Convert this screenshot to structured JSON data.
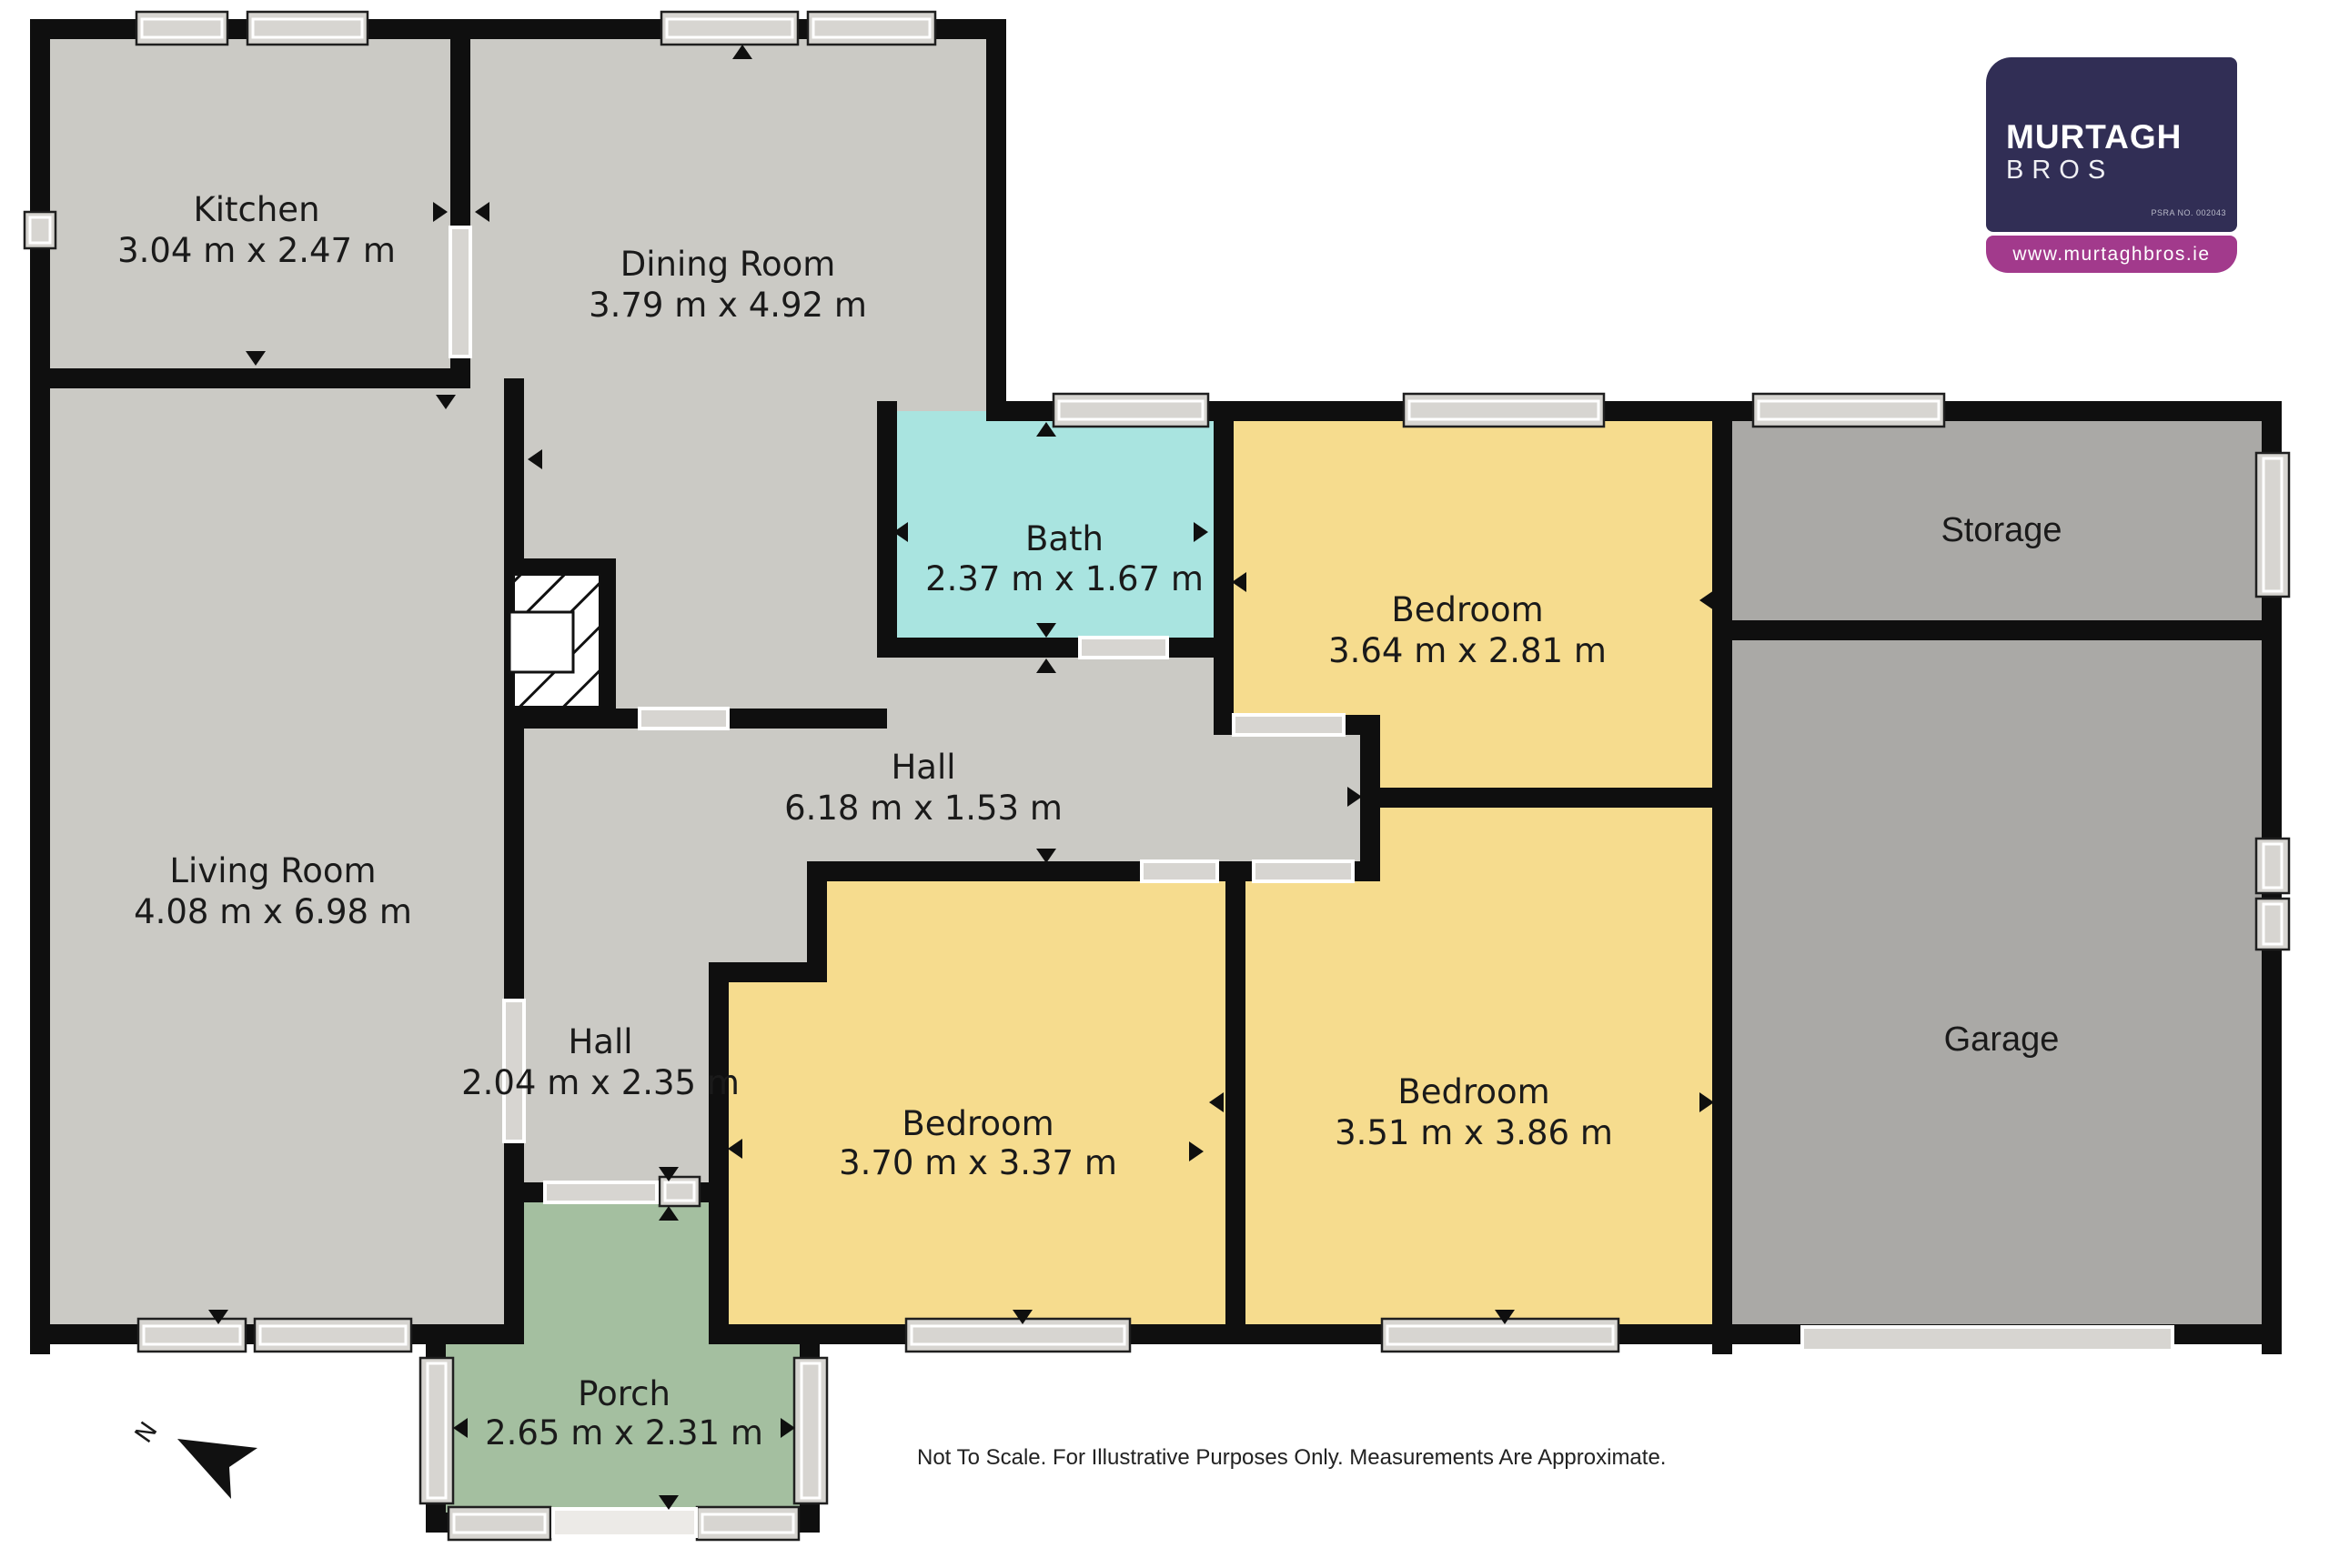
{
  "branding": {
    "name_line1": "MURTAGH",
    "name_line2": "BROS",
    "psra": "PSRA NO. 002043",
    "website": "www.murtaghbros.ie",
    "navy": "#312E55",
    "magenta": "#A23A8C"
  },
  "rooms": {
    "kitchen": {
      "name": "Kitchen",
      "dims": "3.04 m x 2.47 m"
    },
    "dining": {
      "name": "Dining Room",
      "dims": "3.79 m x 4.92 m"
    },
    "living": {
      "name": "Living Room",
      "dims": "4.08 m x 6.98 m"
    },
    "bath": {
      "name": "Bath",
      "dims": "2.37 m x 1.67 m"
    },
    "bedroom_top": {
      "name": "Bedroom",
      "dims": "3.64 m x 2.81 m"
    },
    "hall_main": {
      "name": "Hall",
      "dims": "6.18 m x 1.53 m"
    },
    "hall_front": {
      "name": "Hall",
      "dims": "2.04 m x 2.35 m"
    },
    "bedroom_middle": {
      "name": "Bedroom",
      "dims": "3.70 m x 3.37 m"
    },
    "bedroom_right": {
      "name": "Bedroom",
      "dims": "3.51 m x 3.86 m"
    },
    "porch": {
      "name": "Porch",
      "dims": "2.65 m x 2.31 m"
    },
    "storage": {
      "name": "Storage"
    },
    "garage": {
      "name": "Garage"
    }
  },
  "compass": {
    "label": "N"
  },
  "footer": {
    "disclaimer": "Not To Scale. For Illustrative Purposes Only. Measurements Are Approximate."
  },
  "colors": {
    "room_gray": "#CBCAC5",
    "bath_cyan": "#A9E4E0",
    "bedroom_yellow": "#F6DC8E",
    "porch_green": "#A4BFA0",
    "garage_gray": "#AAA9A6",
    "wall_black": "#0F0F0F",
    "window_gray": "#D7D5D1"
  }
}
